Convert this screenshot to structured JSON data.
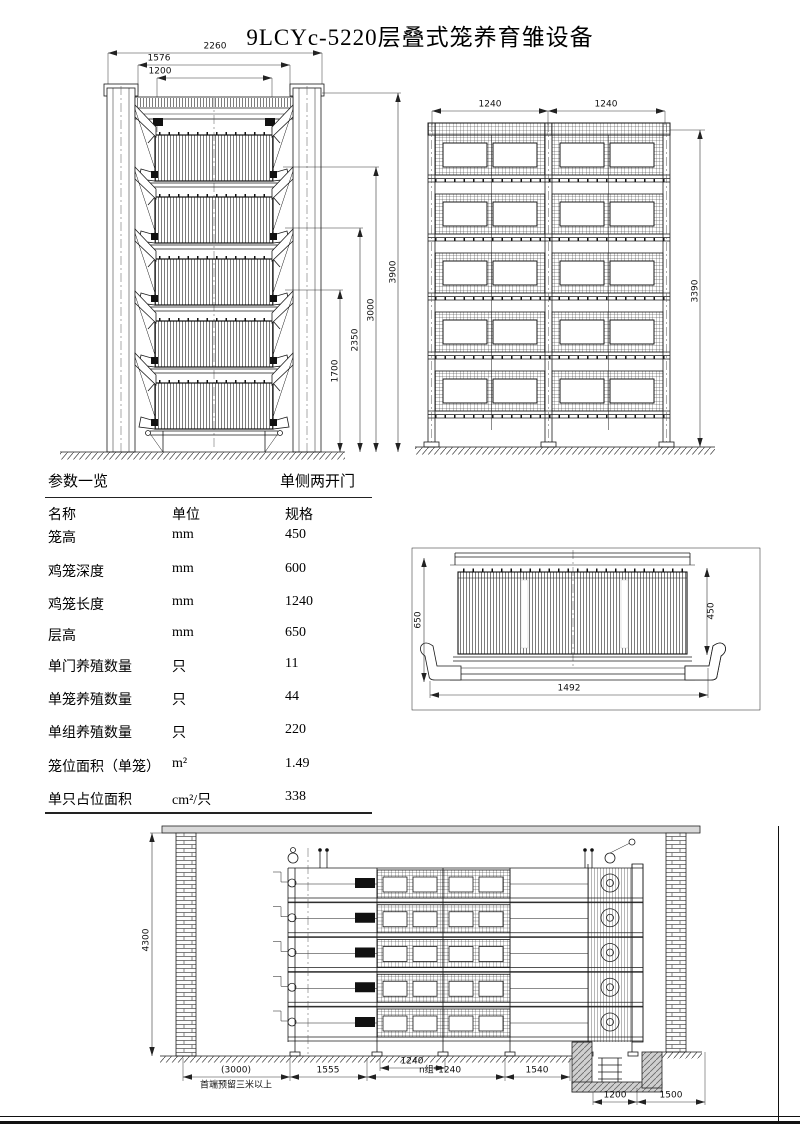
{
  "page": {
    "title": "9LCYc-5220层叠式笼养育雏设备"
  },
  "table": {
    "section_title": "参数一览",
    "variant": "单侧两开门",
    "headers": [
      "名称",
      "单位",
      "规格"
    ],
    "rows": [
      {
        "name": "笼高",
        "unit": "mm",
        "value": "450"
      },
      {
        "name": "鸡笼深度",
        "unit": "mm",
        "value": "600"
      },
      {
        "name": "鸡笼长度",
        "unit": "mm",
        "value": "1240"
      },
      {
        "name": "层高",
        "unit": "mm",
        "value": "650"
      },
      {
        "name": "单门养殖数量",
        "unit": "只",
        "value": "11"
      },
      {
        "name": "单笼养殖数量",
        "unit": "只",
        "value": "44"
      },
      {
        "name": "单组养殖数量",
        "unit": "只",
        "value": "220"
      },
      {
        "name": "笼位面积（单笼）",
        "unit": "m²",
        "value": "1.49"
      },
      {
        "name": "单只占位面积",
        "unit": "cm²/只",
        "value": "338"
      }
    ]
  },
  "dims": {
    "end_view": {
      "total_w": "2260",
      "mid_w": "1576",
      "inner_w": "1200",
      "total_h": "3900",
      "h3": "3000",
      "h2": "2350",
      "h1": "1700"
    },
    "front_view": {
      "bay_left": "1240",
      "bay_right": "1240",
      "height": "3390"
    },
    "section_view": {
      "depth": "650",
      "cage_height": "450",
      "width": "1492"
    },
    "elevation": {
      "wall_height": "4300",
      "reserve": "(3000)",
      "reserve_note": "首端预留三米以上",
      "aisle": "1555",
      "cage": "1240",
      "group": "n组*1240",
      "end_gap": "1540",
      "pit_width": "1200",
      "pit_right": "1500"
    }
  }
}
